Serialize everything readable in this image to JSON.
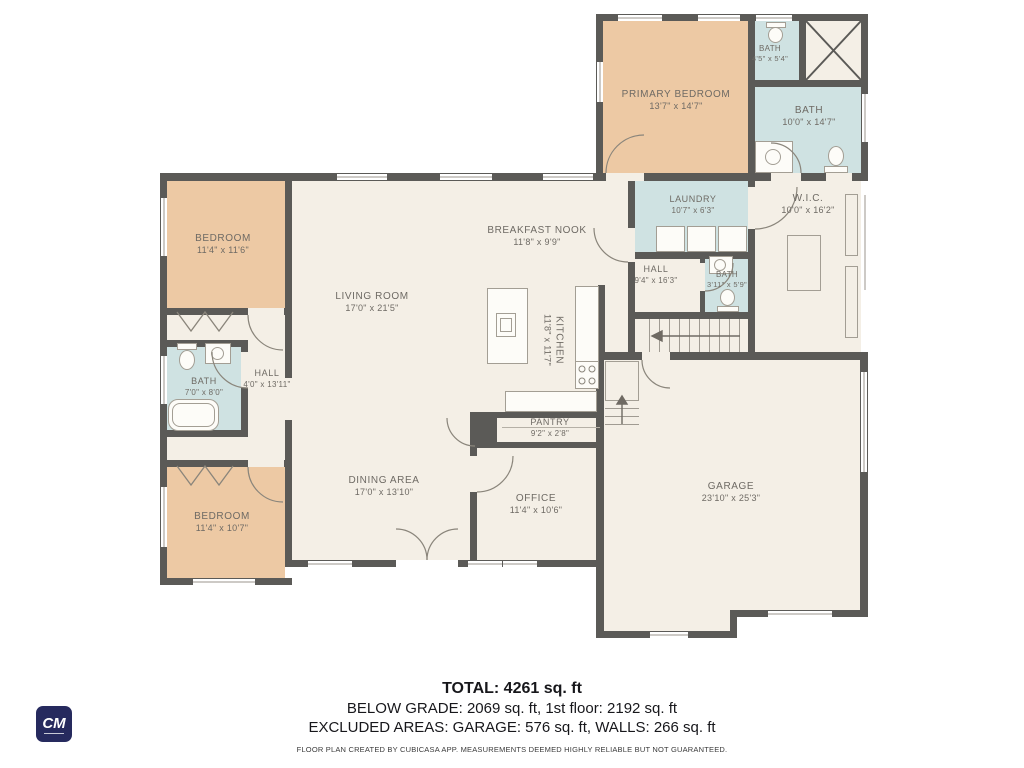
{
  "colors": {
    "bedroom": "#edc9a4",
    "bath": "#cfe2e2",
    "floor": "#f4efe6",
    "wall": "#5b5a57",
    "logo_bg": "#262a5e"
  },
  "rooms": {
    "primary_bedroom": {
      "name": "PRIMARY BEDROOM",
      "dims": "13'7\" x 14'7\""
    },
    "bath_small_top": {
      "name": "BATH",
      "dims": "4'5\" x 5'4\""
    },
    "bath_primary": {
      "name": "BATH",
      "dims": "10'0\" x 14'7\""
    },
    "laundry": {
      "name": "LAUNDRY",
      "dims": "10'7\" x 6'3\""
    },
    "wic": {
      "name": "W.I.C.",
      "dims": "10'0\" x 16'2\""
    },
    "hall_right": {
      "name": "HALL",
      "dims": "9'4\" x 16'3\""
    },
    "bath_hall": {
      "name": "BATH",
      "dims": "3'11\" x 5'9\""
    },
    "bedroom_top": {
      "name": "BEDROOM",
      "dims": "11'4\" x 11'6\""
    },
    "bath_left": {
      "name": "BATH",
      "dims": "7'0\" x 8'0\""
    },
    "hall_left": {
      "name": "HALL",
      "dims": "4'0\" x 13'11\""
    },
    "bedroom_bottom": {
      "name": "BEDROOM",
      "dims": "11'4\" x 10'7\""
    },
    "living_room": {
      "name": "LIVING ROOM",
      "dims": "17'0\" x 21'5\""
    },
    "breakfast_nook": {
      "name": "BREAKFAST NOOK",
      "dims": "11'8\" x 9'9\""
    },
    "kitchen": {
      "name": "KITCHEN",
      "dims": "11'8\" x 11'7\""
    },
    "dining_area": {
      "name": "DINING AREA",
      "dims": "17'0\" x 13'10\""
    },
    "pantry": {
      "name": "PANTRY",
      "dims": "9'2\" x 2'8\""
    },
    "office": {
      "name": "OFFICE",
      "dims": "11'4\" x 10'6\""
    },
    "garage": {
      "name": "GARAGE",
      "dims": "23'10\" x 25'3\""
    }
  },
  "summary": {
    "total": "TOTAL: 4261 sq. ft",
    "below_grade": "BELOW GRADE: 2069 sq. ft, 1st floor: 2192 sq. ft",
    "excluded": "EXCLUDED AREAS: GARAGE: 576 sq. ft, WALLS: 266 sq. ft",
    "disclaimer": "FLOOR PLAN CREATED BY CUBICASA APP. MEASUREMENTS DEEMED HIGHLY RELIABLE BUT NOT GUARANTEED."
  },
  "logo": {
    "text": "CM"
  }
}
